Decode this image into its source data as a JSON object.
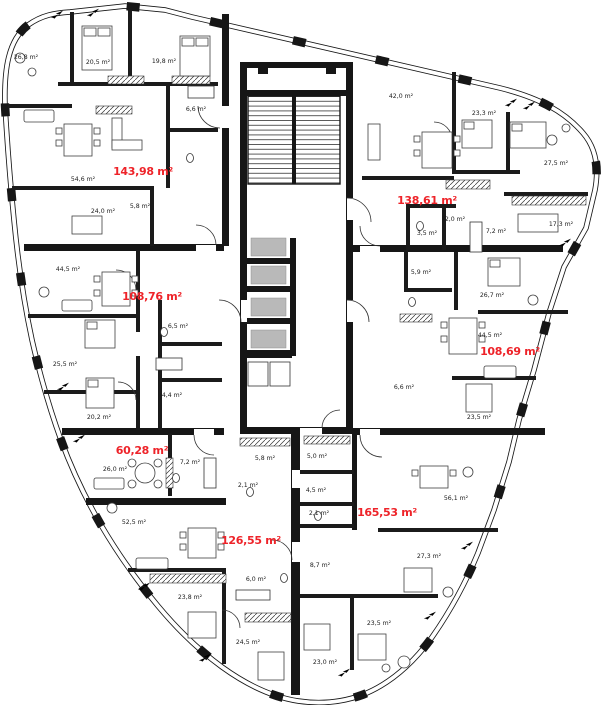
{
  "floorplan": {
    "units_count": 7,
    "area_unit": "m²",
    "accent_red": "#ee2329",
    "wall_color": "#161616",
    "elevator_gray": "#b9b9b9",
    "apartments": [
      {
        "id": "apt-1",
        "total_area": "143,98 m²",
        "label_pos": {
          "x": 143,
          "y": 175
        },
        "rooms": [
          {
            "area": "26,8 m²",
            "x": 26,
            "y": 59
          },
          {
            "area": "20,5 m²",
            "x": 98,
            "y": 64
          },
          {
            "area": "19,8 m²",
            "x": 164,
            "y": 63
          },
          {
            "area": "6,6 m²",
            "x": 196,
            "y": 111
          },
          {
            "area": "54,6 m²",
            "x": 83,
            "y": 181
          },
          {
            "area": "24,0 m²",
            "x": 103,
            "y": 213
          },
          {
            "area": "5,8 m²",
            "x": 140,
            "y": 208
          }
        ]
      },
      {
        "id": "apt-2",
        "total_area": "138,61 m²",
        "label_pos": {
          "x": 427,
          "y": 204
        },
        "rooms": [
          {
            "area": "42,0 m²",
            "x": 401,
            "y": 98
          },
          {
            "area": "23,3 m²",
            "x": 484,
            "y": 115
          },
          {
            "area": "27,5 m²",
            "x": 556,
            "y": 165
          },
          {
            "area": "17,3 m²",
            "x": 561,
            "y": 226
          },
          {
            "area": "7,2 m²",
            "x": 496,
            "y": 233
          },
          {
            "area": "3,5 m²",
            "x": 427,
            "y": 235
          },
          {
            "area": "2,0 m²",
            "x": 455,
            "y": 221
          }
        ]
      },
      {
        "id": "apt-3",
        "total_area": "108,76 m²",
        "label_pos": {
          "x": 152,
          "y": 300
        },
        "rooms": [
          {
            "area": "44,5 m²",
            "x": 68,
            "y": 271
          },
          {
            "area": "6,5 m²",
            "x": 178,
            "y": 328
          },
          {
            "area": "25,5 m²",
            "x": 65,
            "y": 366
          },
          {
            "area": "4,4 m²",
            "x": 172,
            "y": 397
          },
          {
            "area": "20,2 m²",
            "x": 99,
            "y": 419
          }
        ]
      },
      {
        "id": "apt-4",
        "total_area": "108,69 m²",
        "label_pos": {
          "x": 510,
          "y": 355
        },
        "rooms": [
          {
            "area": "5,9 m²",
            "x": 421,
            "y": 274
          },
          {
            "area": "26,7 m²",
            "x": 492,
            "y": 297
          },
          {
            "area": "44,5 m²",
            "x": 490,
            "y": 337
          },
          {
            "area": "6,6 m²",
            "x": 404,
            "y": 389
          },
          {
            "area": "23,5 m²",
            "x": 479,
            "y": 419
          }
        ]
      },
      {
        "id": "apt-5",
        "total_area": "60,28 m²",
        "label_pos": {
          "x": 142,
          "y": 454
        },
        "rooms": [
          {
            "area": "26,0 m²",
            "x": 115,
            "y": 471
          },
          {
            "area": "7,2 m²",
            "x": 190,
            "y": 464
          }
        ]
      },
      {
        "id": "apt-6",
        "total_area": "126,55 m²",
        "label_pos": {
          "x": 251,
          "y": 544
        },
        "rooms": [
          {
            "area": "2,1 m²",
            "x": 248,
            "y": 487
          },
          {
            "area": "5,8 m²",
            "x": 265,
            "y": 460
          },
          {
            "area": "52,5 m²",
            "x": 134,
            "y": 524
          },
          {
            "area": "6,0 m²",
            "x": 256,
            "y": 581
          },
          {
            "area": "23,8 m²",
            "x": 190,
            "y": 599
          },
          {
            "area": "24,5 m²",
            "x": 248,
            "y": 644
          }
        ]
      },
      {
        "id": "apt-7",
        "total_area": "165,53 m²",
        "label_pos": {
          "x": 387,
          "y": 516
        },
        "rooms": [
          {
            "area": "5,0 m²",
            "x": 317,
            "y": 458
          },
          {
            "area": "4,5 m²",
            "x": 316,
            "y": 492
          },
          {
            "area": "2,1 m²",
            "x": 319,
            "y": 515
          },
          {
            "area": "56,1 m²",
            "x": 456,
            "y": 500
          },
          {
            "area": "8,7 m²",
            "x": 320,
            "y": 567
          },
          {
            "area": "27,3 m²",
            "x": 429,
            "y": 558
          },
          {
            "area": "23,5 m²",
            "x": 379,
            "y": 625
          },
          {
            "area": "23,0 m²",
            "x": 325,
            "y": 664
          }
        ]
      }
    ],
    "decor": {
      "arrow_symbol": "double-arrow",
      "arrow_positions": [
        {
          "x": 50,
          "y": 10
        },
        {
          "x": 86,
          "y": 8
        },
        {
          "x": 504,
          "y": 98
        },
        {
          "x": 522,
          "y": 101
        },
        {
          "x": 558,
          "y": 238
        },
        {
          "x": 56,
          "y": 382
        },
        {
          "x": 72,
          "y": 434
        },
        {
          "x": 137,
          "y": 582
        },
        {
          "x": 198,
          "y": 653
        },
        {
          "x": 337,
          "y": 668
        },
        {
          "x": 460,
          "y": 541
        },
        {
          "x": 423,
          "y": 611
        }
      ]
    }
  }
}
